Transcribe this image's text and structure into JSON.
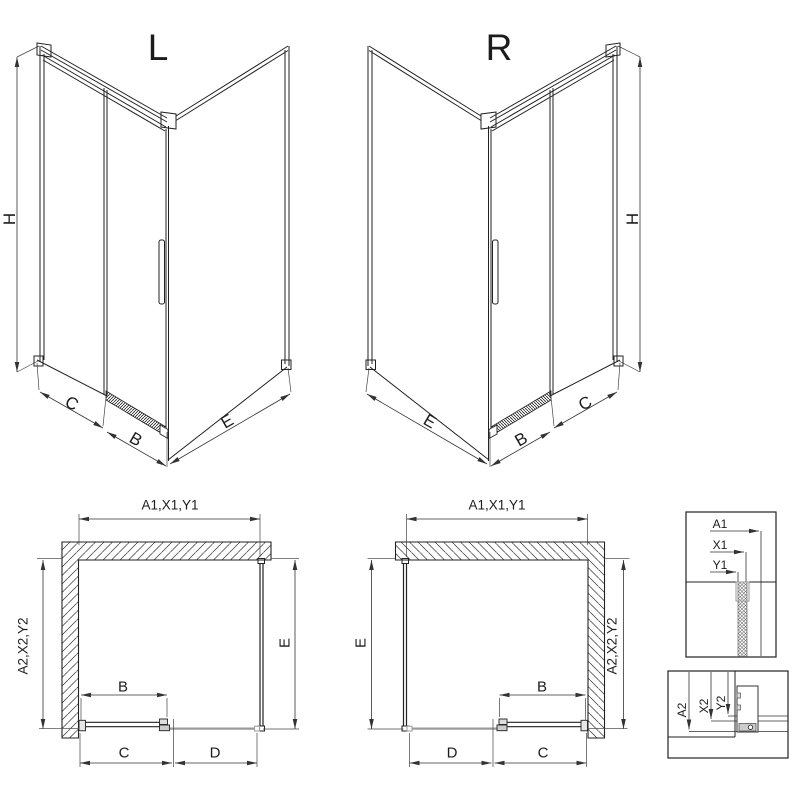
{
  "perspective_left": {
    "title": "L",
    "height": "H",
    "side": "C",
    "door": "B",
    "depth": "E"
  },
  "perspective_right": {
    "title": "R",
    "height": "H",
    "side": "C",
    "door": "B",
    "depth": "E"
  },
  "plan_left": {
    "top": "A1,X1,Y1",
    "side": "A2,X2,Y2",
    "depth": "E",
    "door": "B",
    "c": "C",
    "d": "D"
  },
  "plan_right": {
    "top": "A1,X1,Y1",
    "side": "A2,X2,Y2",
    "depth": "E",
    "door": "B",
    "c": "C",
    "d": "D"
  },
  "detail_wall_profile": {
    "a1": "A1",
    "x1": "X1",
    "y1": "Y1"
  },
  "detail_bottom_rail": {
    "a2": "A2",
    "x2": "X2",
    "y2": "Y2"
  },
  "colors": {
    "line": "#222222",
    "grey": "#9a9a9a",
    "background": "#ffffff"
  }
}
